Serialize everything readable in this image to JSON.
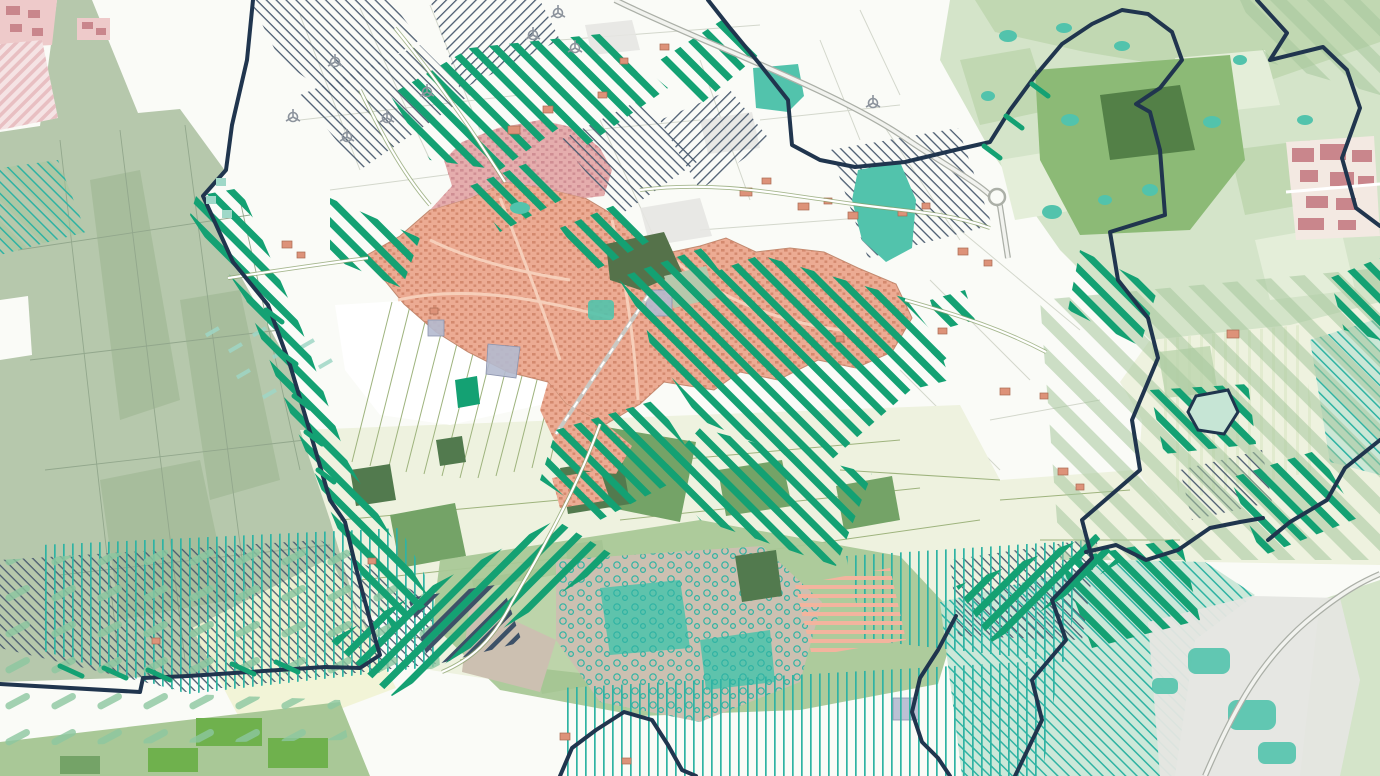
{
  "map": {
    "kind": "land-use / nature designation planning map",
    "palette": {
      "paper": "#fafbf7",
      "white": "#ffffff",
      "parcel_gray": "#d3d7cc",
      "parcel_olive": "#9eb37d",
      "sage": "#b6c8ac",
      "sage_dark": "#a7bd9c",
      "sage_line": "#92a78c",
      "sage_band": "#a6c69d",
      "pale": "#eef2df",
      "pale_dark": "#e2ebcf",
      "cream": "#f1f3d3",
      "mid_green": "#74a367",
      "dark_green": "#527a4e",
      "bright_green": "#6fb14d",
      "belt_green": "#a9c897",
      "belt_light": "#bdd4aa",
      "muted": "#d4e4c9",
      "muted_dark": "#bcd5ad",
      "muted_light": "#e4eed9",
      "forest": "#8cba76",
      "forest_dark": "#4d7a43",
      "emerald": "#14a173",
      "teal": "#52c3ac",
      "teal_line": "#2fb3a3",
      "mint": "#c6e5d5",
      "navy": "#20354e",
      "navy_stripe": "#3d5168",
      "hatch_dark": "#4b5c70",
      "town": "#ecab93",
      "town_dark": "#cf8368",
      "rose": "#e5adad",
      "rose_dark": "#c9868c",
      "town_road": "#f6cfba",
      "pink": "#eecaca",
      "pink_stripe": "#e8bfc2",
      "farm": "#dd9279",
      "farm_line": "#a96a52",
      "salmon_stripe": "#f3b49e",
      "gray_zone": "#e5e6e2",
      "taupe": "#ccc0b1",
      "lavender": "#b4bacf",
      "lavender_line": "#8b93ad",
      "road": "#c9cdc2",
      "road_casing": "#abafa7",
      "road_fill": "#f2f3ef",
      "rail": "#c9c9c4",
      "turbine": "#8d949d",
      "comb": "#8cc7a0",
      "olive_dark": "#55724a"
    },
    "layers": [
      {
        "id": "field-parcels",
        "label": "Field parcels (white / pale green with olive outlines)"
      },
      {
        "id": "built-up-area",
        "label": "Village built-up area (salmon with building texture, rose overlay north)"
      },
      {
        "id": "green-hatch-zones",
        "label": "Emerald diagonal-striped designation zones"
      },
      {
        "id": "thin-hatch-zones",
        "label": "Thin dark diagonal hatched parcels"
      },
      {
        "id": "teal-stripe-zones",
        "label": "Teal vertical-line hatched zones"
      },
      {
        "id": "sage-band-zones",
        "label": "Wide translucent sage diagonal bands"
      },
      {
        "id": "woodland",
        "label": "Woodland blocks and teal-textured forest"
      },
      {
        "id": "water-features",
        "label": "Teal ponds and wet heath patches"
      },
      {
        "id": "boundary",
        "label": "Dark navy municipal boundary and meandering watercourse"
      },
      {
        "id": "roads",
        "label": "Rural roads, highway with roundabout, railway"
      },
      {
        "id": "wind-turbines",
        "label": "Wind turbine symbols"
      }
    ],
    "wind_turbines": [
      {
        "x": 335,
        "y": 62
      },
      {
        "x": 387,
        "y": 118
      },
      {
        "x": 427,
        "y": 92
      },
      {
        "x": 293,
        "y": 117
      },
      {
        "x": 347,
        "y": 137
      },
      {
        "x": 558,
        "y": 13
      },
      {
        "x": 533,
        "y": 35
      },
      {
        "x": 575,
        "y": 48
      },
      {
        "x": 873,
        "y": 103
      }
    ]
  }
}
